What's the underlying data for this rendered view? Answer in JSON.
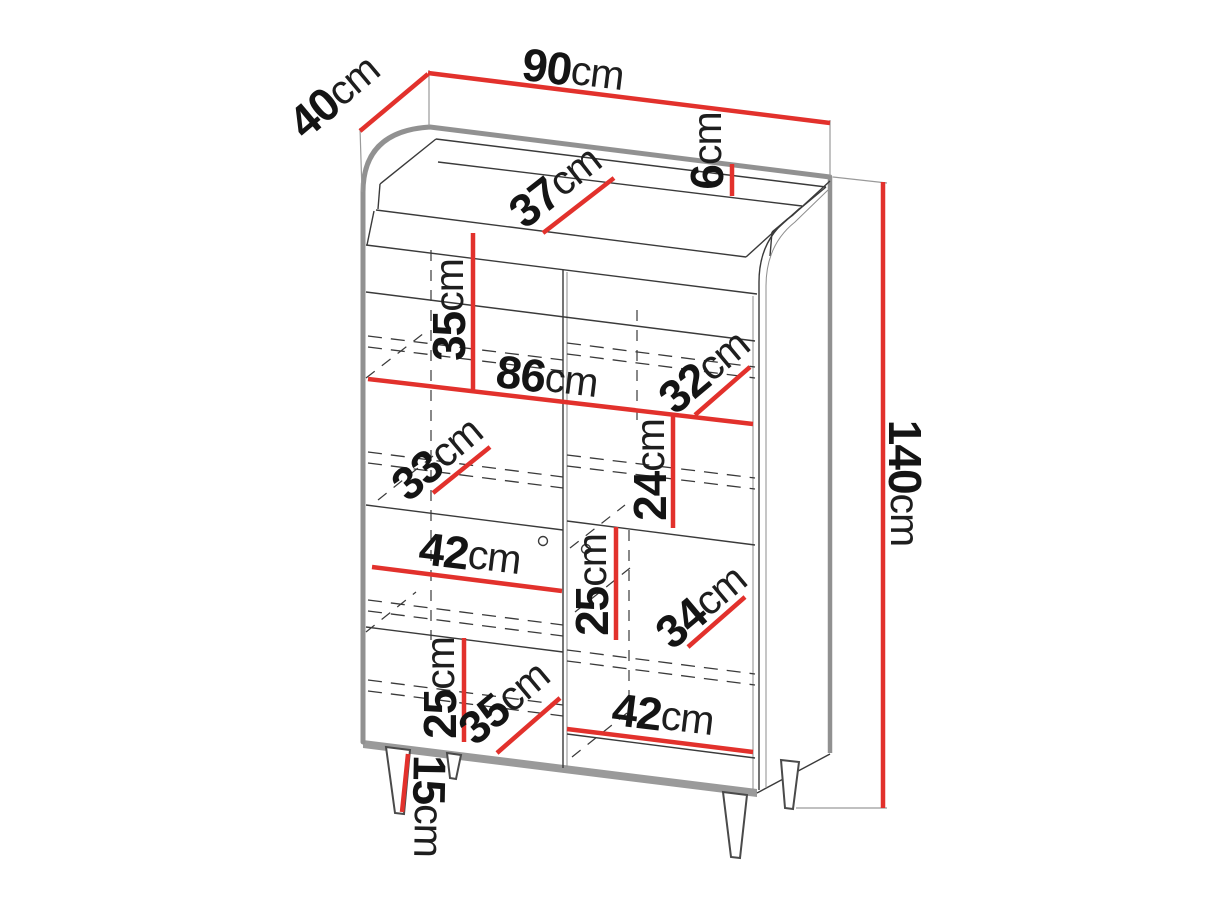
{
  "diagram": {
    "type": "furniture-dimension-drawing",
    "subject": "highboard display cabinet line drawing with dimension callouts",
    "unit": "cm",
    "accent_color": "#e2312c",
    "outline_color": "#919191",
    "dimensions": {
      "depth": {
        "value": "40",
        "unit": "cm"
      },
      "width": {
        "value": "90",
        "unit": "cm"
      },
      "top_recess_depth": {
        "value": "37",
        "unit": "cm"
      },
      "top_lip_height": {
        "value": "6",
        "unit": "cm"
      },
      "upper_section_height": {
        "value": "35",
        "unit": "cm"
      },
      "interior_width": {
        "value": "86",
        "unit": "cm"
      },
      "upper_shelf_depth": {
        "value": "32",
        "unit": "cm"
      },
      "middle_section_height": {
        "value": "24",
        "unit": "cm"
      },
      "middle_shelf_depth": {
        "value": "33",
        "unit": "cm"
      },
      "left_compartment_width": {
        "value": "42",
        "unit": "cm"
      },
      "right_section_height": {
        "value": "25",
        "unit": "cm"
      },
      "lower_shelf_depth_right": {
        "value": "34",
        "unit": "cm"
      },
      "lower_section_height": {
        "value": "25",
        "unit": "cm"
      },
      "lower_shelf_depth_left": {
        "value": "35",
        "unit": "cm"
      },
      "right_compartment_width": {
        "value": "42",
        "unit": "cm"
      },
      "leg_height": {
        "value": "15",
        "unit": "cm"
      },
      "total_height": {
        "value": "140",
        "unit": "cm"
      }
    }
  }
}
